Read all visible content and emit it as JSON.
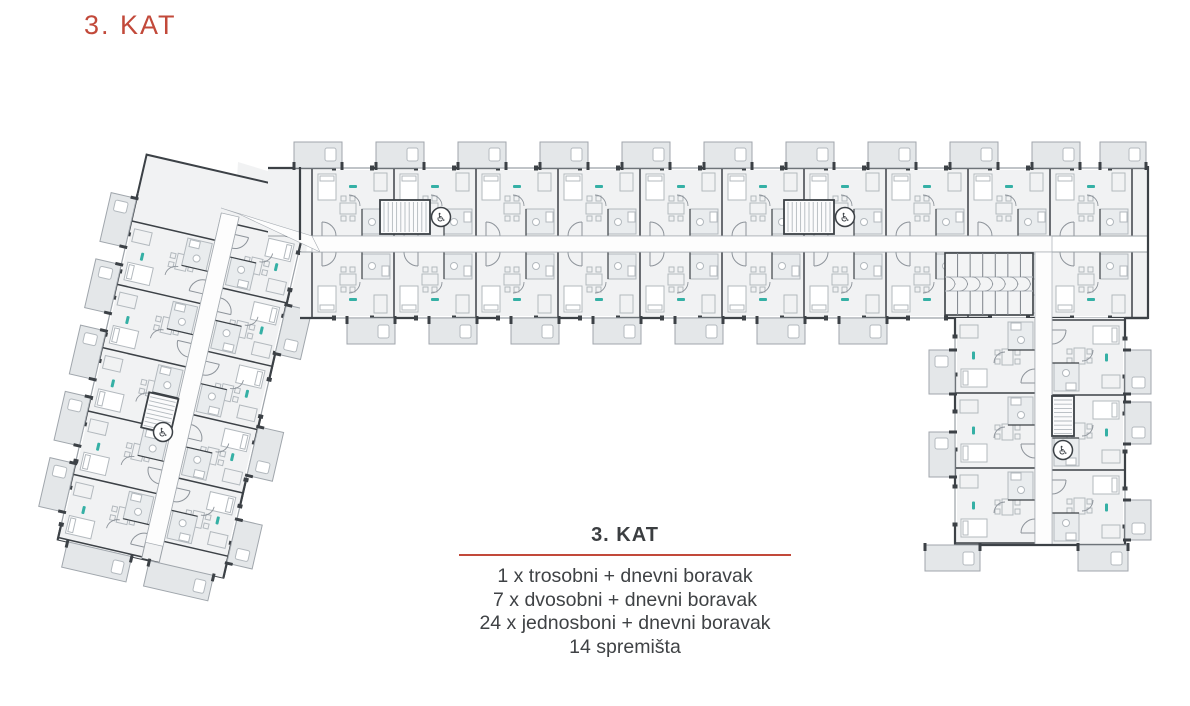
{
  "page": {
    "background": "#ffffff"
  },
  "header": {
    "title": "3. KAT",
    "color": "#c2493a"
  },
  "legend": {
    "title": "3. KAT",
    "divider_color": "#c2493a",
    "lines": [
      "1 x trosobni + dnevni boravak",
      "7 x dvosobni + dnevni boravak",
      "24 x jednosboni + dnevni boravak",
      "14 spremišta"
    ]
  },
  "plan": {
    "colors": {
      "wall": "#3c4146",
      "line": "#b3b9be",
      "room_fill": "#f1f2f3",
      "bath_fill": "#e9ecee",
      "balcony_fill": "#e4e7e9",
      "corridor_fill": "#fdfdfd",
      "window": "#9ba1a7",
      "door": "#8d939a",
      "unit_label": "#35b0a5"
    },
    "icons": {
      "accessibility": "♿"
    }
  }
}
